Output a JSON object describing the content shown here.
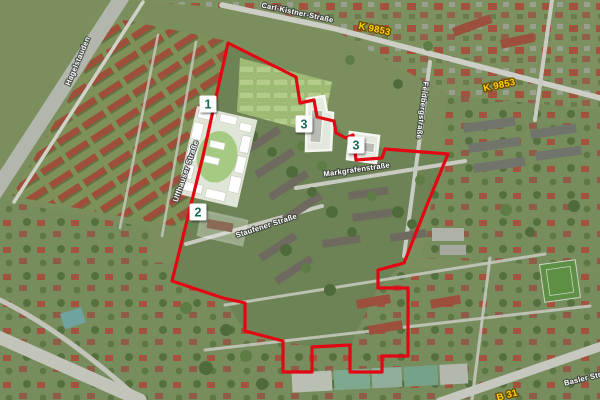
{
  "map": {
    "view": "aerial-satellite-photo",
    "colors": {
      "boundary_red": "#e30613",
      "site_outline_white": "#ffffff",
      "marker_number_green": "#166a58",
      "road_number_yellow": "#ffd400"
    },
    "markers": [
      {
        "label": "1",
        "x": 208,
        "y": 104
      },
      {
        "label": "2",
        "x": 198,
        "y": 212
      },
      {
        "label": "3",
        "x": 304,
        "y": 124
      },
      {
        "label": "3",
        "x": 356,
        "y": 145
      }
    ],
    "road_badges": [
      {
        "text": "K 9853",
        "x": 374,
        "y": 32,
        "rotate": 12
      },
      {
        "text": "K 9853",
        "x": 500,
        "y": 88,
        "rotate": -12
      },
      {
        "text": "B 31",
        "x": 508,
        "y": 398,
        "rotate": -16
      }
    ],
    "street_labels": [
      {
        "text": "Carl-Kistner-Straße",
        "x": 297,
        "y": 15,
        "rotate": 12
      },
      {
        "text": "Hagelstauden",
        "x": 80,
        "y": 62,
        "rotate": -67
      },
      {
        "text": "Uffhauser Straße",
        "x": 188,
        "y": 172,
        "rotate": -71
      },
      {
        "text": "Markgrafenstraße",
        "x": 357,
        "y": 172,
        "rotate": -8
      },
      {
        "text": "Staufener Straße",
        "x": 267,
        "y": 228,
        "rotate": -18
      },
      {
        "text": "Feldbergstraße",
        "x": 420,
        "y": 110,
        "rotate": 97
      },
      {
        "text": "Basler Str.",
        "x": 584,
        "y": 381,
        "rotate": -14
      }
    ]
  }
}
